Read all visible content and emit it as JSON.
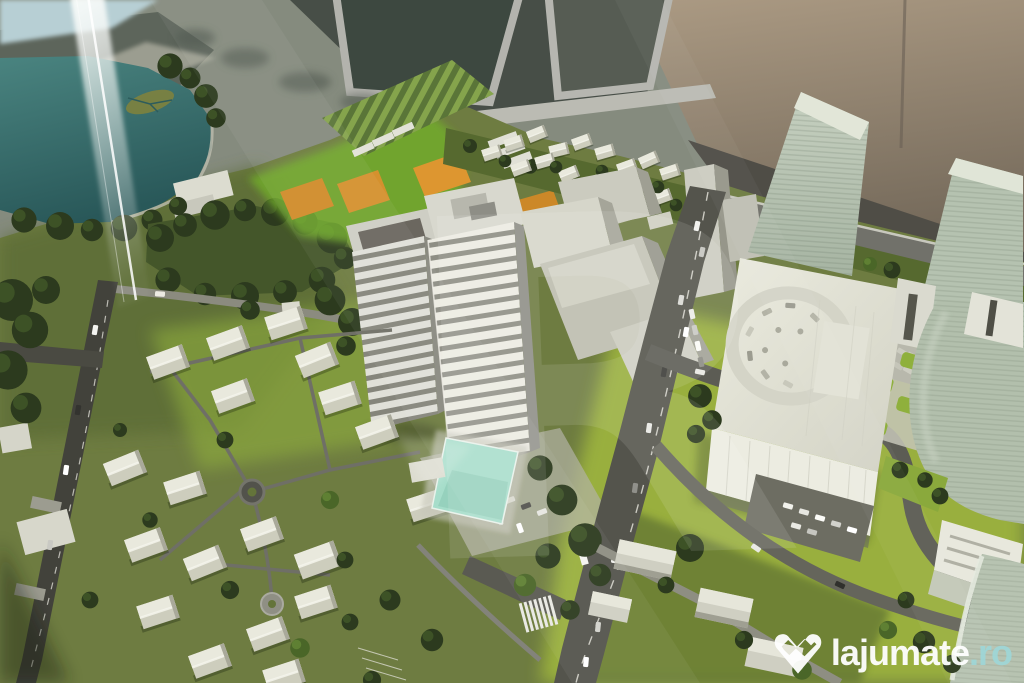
{
  "meta": {
    "type": "photograph",
    "subject": "architectural scale model of an urban development displayed behind glass"
  },
  "watermark": {
    "brand": "lajumate",
    "tld": ".ro",
    "logo_icon": "lajumate-heart-w-icon",
    "brand_color": "#ffffff",
    "tld_color": "#9fd6d6"
  },
  "ghost_watermark": {
    "letter": "R",
    "opacity": 0.1
  },
  "palette": {
    "terrain_olive": "#6e7c41",
    "terrain_shadow": "#44562a",
    "lawn_bright": "#a8c13c",
    "field_green": "#72ae29",
    "lake_teal": "#3a7370",
    "pool_cyan": "#a6ddca",
    "field_orange": "#d08c2a",
    "road_dark": "#54544c",
    "path_light": "#8b8b7f",
    "building_white": "#e1e1d6",
    "tower_floor_dark": "#8e8e84",
    "tower_pale_green": "#b5c2b0",
    "tree_dark": "#2c3a1e",
    "glass_dark": "#3d4840",
    "frame_grey": "#b3b3ad",
    "wall_warm": "#ab9a83",
    "sky_patch": "#b7cfd4"
  }
}
